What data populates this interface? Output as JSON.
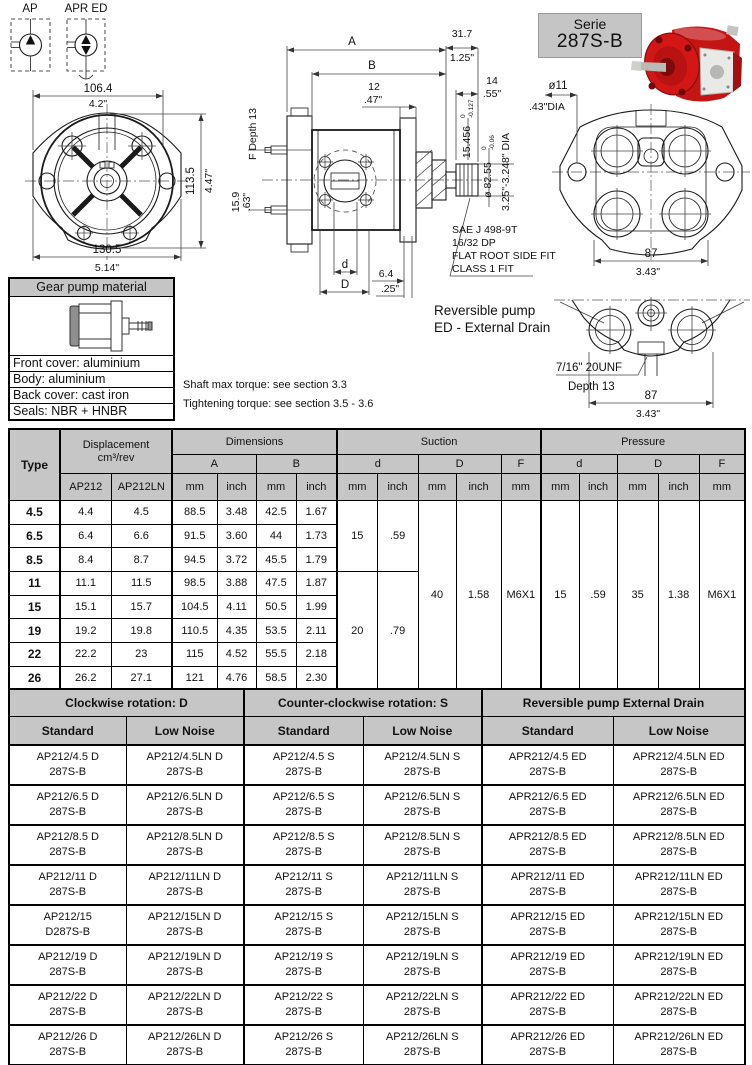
{
  "colors": {
    "header_gray": "#c6c6c6",
    "line": "#1a1a1a",
    "pump_red": "#c51414"
  },
  "symbols": {
    "ap": "AP",
    "apr_ed": "APR ED"
  },
  "front_view": {
    "w_mm": "106.4",
    "w_in": "4.2\"",
    "h_mm": "113.5",
    "h_in": "4.47\"",
    "ow_mm": "130.5",
    "ow_in": "5.14\""
  },
  "side_view": {
    "a": "A",
    "b": "B",
    "d12_mm": "12",
    "d12_in": ".47\"",
    "d317_mm": "31.7",
    "d317_in": "1.25\"",
    "d14_mm": "14",
    "d14_in": ".55\"",
    "f_depth": "F Depth 13",
    "d159_mm": "15.9",
    "d159_in": ".63\"",
    "d_label": "d",
    "D_label": "D",
    "d64_mm": "6.4",
    "d64_in": ".25\"",
    "shaft_mm": "15.456",
    "shaft_tol_hi": "0",
    "shaft_tol_lo": "-0.127",
    "shaft_dia": "ø 82.55",
    "dia_tol_hi": "0",
    "dia_tol_lo": "-0.06",
    "dia_in": "3.25\"-3.248\" DIA",
    "sae1": "SAE J 498-9T",
    "sae2": "16/32 DP",
    "sae3": "FLAT ROOT SIDE FIT",
    "sae4": "CLASS 1 FIT"
  },
  "serie": {
    "line1": "Serie",
    "line2": "287S-B"
  },
  "rear_view": {
    "hole_mm": "ø11",
    "hole_in": ".43\"DIA",
    "w_mm": "87",
    "w_in": "3.43\""
  },
  "reversible": {
    "title1": "Reversible pump",
    "title2": "ED - External Drain",
    "thread": "7/16\" 20UNF",
    "depth": "Depth 13",
    "w_mm": "87",
    "w_in": "3.43\""
  },
  "material": {
    "title": "Gear pump material",
    "rows": [
      "Front cover: aluminium",
      "Body: aluminium",
      "Back cover: cast iron",
      "Seals: NBR + HNBR"
    ]
  },
  "notes": {
    "torque": "Shaft max torque: see section 3.3",
    "tightening": "Tightening torque: see section 3.5 - 3.6"
  },
  "dim_table": {
    "type_h": "Type",
    "displacement_h": "Displacement\ncm³/rev",
    "dimensions_h": "Dimensions",
    "suction_h": "Suction",
    "pressure_h": "Pressure",
    "ap212": "AP212",
    "ap212ln": "AP212LN",
    "a": "A",
    "b": "B",
    "d": "d",
    "D": "D",
    "f": "F",
    "mm": "mm",
    "inch": "inch",
    "rows": [
      {
        "type": "4.5",
        "ap": "4.4",
        "apln": "4.5",
        "a_mm": "88.5",
        "a_in": "3.48",
        "b_mm": "42.5",
        "b_in": "1.67"
      },
      {
        "type": "6.5",
        "ap": "6.4",
        "apln": "6.6",
        "a_mm": "91.5",
        "a_in": "3.60",
        "b_mm": "44",
        "b_in": "1.73"
      },
      {
        "type": "8.5",
        "ap": "8.4",
        "apln": "8.7",
        "a_mm": "94.5",
        "a_in": "3.72",
        "b_mm": "45.5",
        "b_in": "1.79"
      },
      {
        "type": "11",
        "ap": "11.1",
        "apln": "11.5",
        "a_mm": "98.5",
        "a_in": "3.88",
        "b_mm": "47.5",
        "b_in": "1.87"
      },
      {
        "type": "15",
        "ap": "15.1",
        "apln": "15.7",
        "a_mm": "104.5",
        "a_in": "4.11",
        "b_mm": "50.5",
        "b_in": "1.99"
      },
      {
        "type": "19",
        "ap": "19.2",
        "apln": "19.8",
        "a_mm": "110.5",
        "a_in": "4.35",
        "b_mm": "53.5",
        "b_in": "2.11"
      },
      {
        "type": "22",
        "ap": "22.2",
        "apln": "23",
        "a_mm": "115",
        "a_in": "4.52",
        "b_mm": "55.5",
        "b_in": "2.18"
      },
      {
        "type": "26",
        "ap": "26.2",
        "apln": "27.1",
        "a_mm": "121",
        "a_in": "4.76",
        "b_mm": "58.5",
        "b_in": "2.30"
      }
    ],
    "suction": {
      "d_mm_a": "15",
      "d_in_a": ".59",
      "d_mm_b": "20",
      "d_in_b": ".79",
      "D_mm": "40",
      "D_in": "1.58",
      "f": "M6X1"
    },
    "pressure": {
      "d_mm": "15",
      "d_in": ".59",
      "D_mm": "35",
      "D_in": "1.38",
      "f": "M6X1"
    }
  },
  "part_table": {
    "groups": [
      "Clockwise rotation: D",
      "Counter-clockwise rotation: S",
      "Reversible pump External Drain"
    ],
    "subheaders": [
      "Standard",
      "Low Noise",
      "Standard",
      "Low Noise",
      "Standard",
      "Low Noise"
    ],
    "rows": [
      [
        "AP212/4.5 D\n287S-B",
        "AP212/4.5LN D\n287S-B",
        "AP212/4.5 S\n287S-B",
        "AP212/4.5LN S\n287S-B",
        "APR212/4.5 ED\n287S-B",
        "APR212/4.5LN ED\n287S-B"
      ],
      [
        "AP212/6.5 D\n287S-B",
        "AP212/6.5LN D\n287S-B",
        "AP212/6.5 S\n287S-B",
        "AP212/6.5LN S\n287S-B",
        "APR212/6.5 ED\n287S-B",
        "APR212/6.5LN ED\n287S-B"
      ],
      [
        "AP212/8.5 D\n287S-B",
        "AP212/8.5LN D\n287S-B",
        "AP212/8.5 S\n287S-B",
        "AP212/8.5LN S\n287S-B",
        "APR212/8.5 ED\n287S-B",
        "APR212/8.5LN ED\n287S-B"
      ],
      [
        "AP212/11 D\n287S-B",
        "AP212/11LN D\n287S-B",
        "AP212/11 S\n287S-B",
        "AP212/11LN S\n287S-B",
        "APR212/11 ED\n287S-B",
        "APR212/11LN ED\n287S-B"
      ],
      [
        "AP212/15\nD287S-B",
        "AP212/15LN D\n287S-B",
        "AP212/15 S\n287S-B",
        "AP212/15LN S\n287S-B",
        "APR212/15 ED\n287S-B",
        "APR212/15LN ED\n287S-B"
      ],
      [
        "AP212/19 D\n287S-B",
        "AP212/19LN D\n287S-B",
        "AP212/19 S\n287S-B",
        "AP212/19LN S\n287S-B",
        "APR212/19 ED\n287S-B",
        "APR212/19LN ED\n287S-B"
      ],
      [
        "AP212/22 D\n287S-B",
        "AP212/22LN D\n287S-B",
        "AP212/22 S\n287S-B",
        "AP212/22LN S\n287S-B",
        "APR212/22 ED\n287S-B",
        "APR212/22LN ED\n287S-B"
      ],
      [
        "AP212/26 D\n287S-B",
        "AP212/26LN D\n287S-B",
        "AP212/26 S\n287S-B",
        "AP212/26LN S\n287S-B",
        "APR212/26 ED\n287S-B",
        "APR212/26LN ED\n287S-B"
      ]
    ]
  }
}
